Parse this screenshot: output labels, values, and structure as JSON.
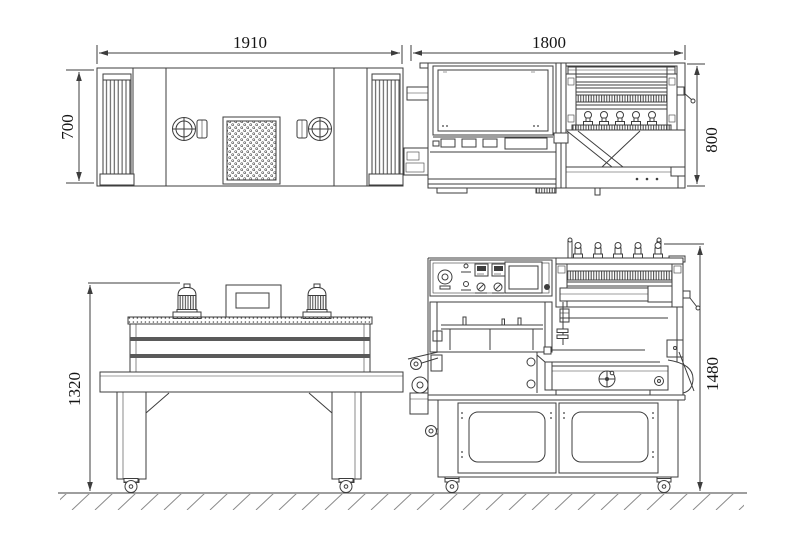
{
  "dims": {
    "tunnel_width": "1910",
    "tunnel_depth": "700",
    "tunnel_height": "1320",
    "sealer_width": "1800",
    "sealer_depth": "800",
    "sealer_height": "1480"
  },
  "colors": {
    "background": "#ffffff",
    "line": "#3d3d3d",
    "dim_text": "#151515",
    "ground_hatch": "#8a8a8a"
  }
}
